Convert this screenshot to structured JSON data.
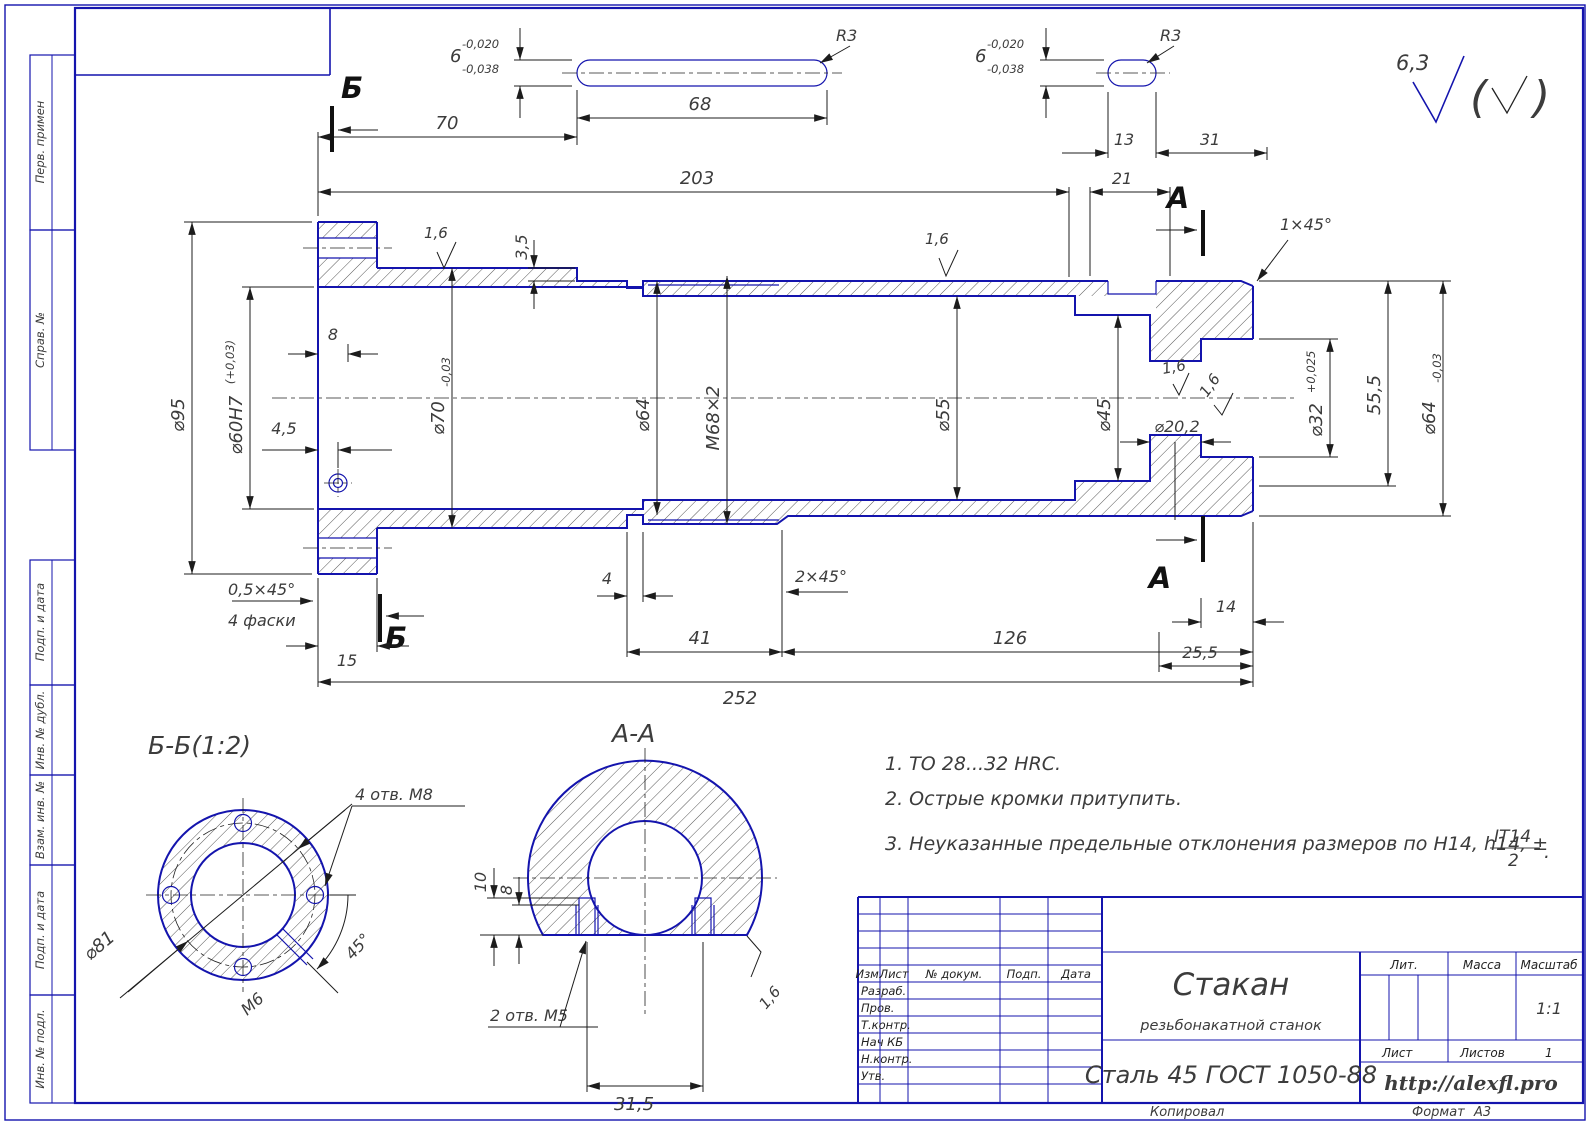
{
  "sheet": {
    "margin_stamps": [
      "Перв. примен",
      "Справ. №",
      "Подп. и дата",
      "Инв. № дубл.",
      "Взам. инв. №",
      "Подп. и дата",
      "Инв. № подл."
    ],
    "copied": "Копировал",
    "format_label": "Формат",
    "format_value": "А3"
  },
  "roughness": {
    "corner": "6,3",
    "mark": "1,6"
  },
  "keyway": {
    "width": "6",
    "tol_top": "-0,020",
    "tol_bot": "-0,038",
    "radius": "R3"
  },
  "dims": {
    "top": {
      "l70": "70",
      "l68": "68",
      "l203": "203",
      "l13": "13",
      "l31": "31",
      "l21": "21",
      "depth": "3,5",
      "chamfer": "1×45°"
    },
    "left": {
      "d95": "⌀95",
      "d60": "⌀60H7",
      "d60_tol": "(+0,03)",
      "l8": "8",
      "l4_5": "4,5"
    },
    "diam": {
      "d70": "⌀70",
      "d70_tol": "-0,03",
      "d64": "⌀64",
      "m68": "М68×2",
      "d55": "⌀55",
      "d45": "⌀45",
      "d32": "⌀32",
      "d32_tol": "+0,025",
      "l55_5": "55,5",
      "d64r": "⌀64",
      "d64r_tol": "-0,03",
      "d20_2": "⌀20,2"
    },
    "bottom": {
      "chamfer05": "0,5×45°",
      "facets": "4 фаски",
      "l15": "15",
      "l4": "4",
      "chamfer2": "2×45°",
      "l41": "41",
      "l126": "126",
      "l252": "252",
      "l14": "14",
      "l25_5": "25,5"
    }
  },
  "marks": {
    "a": "А",
    "b": "Б"
  },
  "section_b": {
    "title": "Б-Б(1:2)",
    "holes": "4 отв. М8",
    "d81": "⌀81",
    "m6": "М6",
    "angle": "45°"
  },
  "section_a": {
    "title": "А-А",
    "l10": "10",
    "l8": "8",
    "holes": "2 отв. М5",
    "l31_5": "31,5"
  },
  "notes": {
    "n1": "1.  ТО 28...32 HRC.",
    "n2": "2.  Острые кромки притупить.",
    "n3": "3.  Неуказанные предельные отклонения размеров по H14, h14, ±",
    "frac_num": "IT14",
    "frac_den": "2",
    "tail": "."
  },
  "title_block": {
    "headers": [
      "Изм.",
      "Лист",
      "№ докум.",
      "Подп.",
      "Дата"
    ],
    "roles": [
      "Разраб.",
      "Пров.",
      "Т.контр.",
      "Нач КБ",
      "Н.контр.",
      "Утв."
    ],
    "name": "Стакан",
    "subtitle": "резьбонакатной станок",
    "material": "Сталь 45 ГОСТ 1050-88",
    "url": "http://alexfl.pro",
    "lit": "Лит.",
    "mass": "Масса",
    "scale_label": "Масштаб",
    "scale": "1:1",
    "sheet": "Лист",
    "sheets": "Листов",
    "sheets_value": "1"
  }
}
